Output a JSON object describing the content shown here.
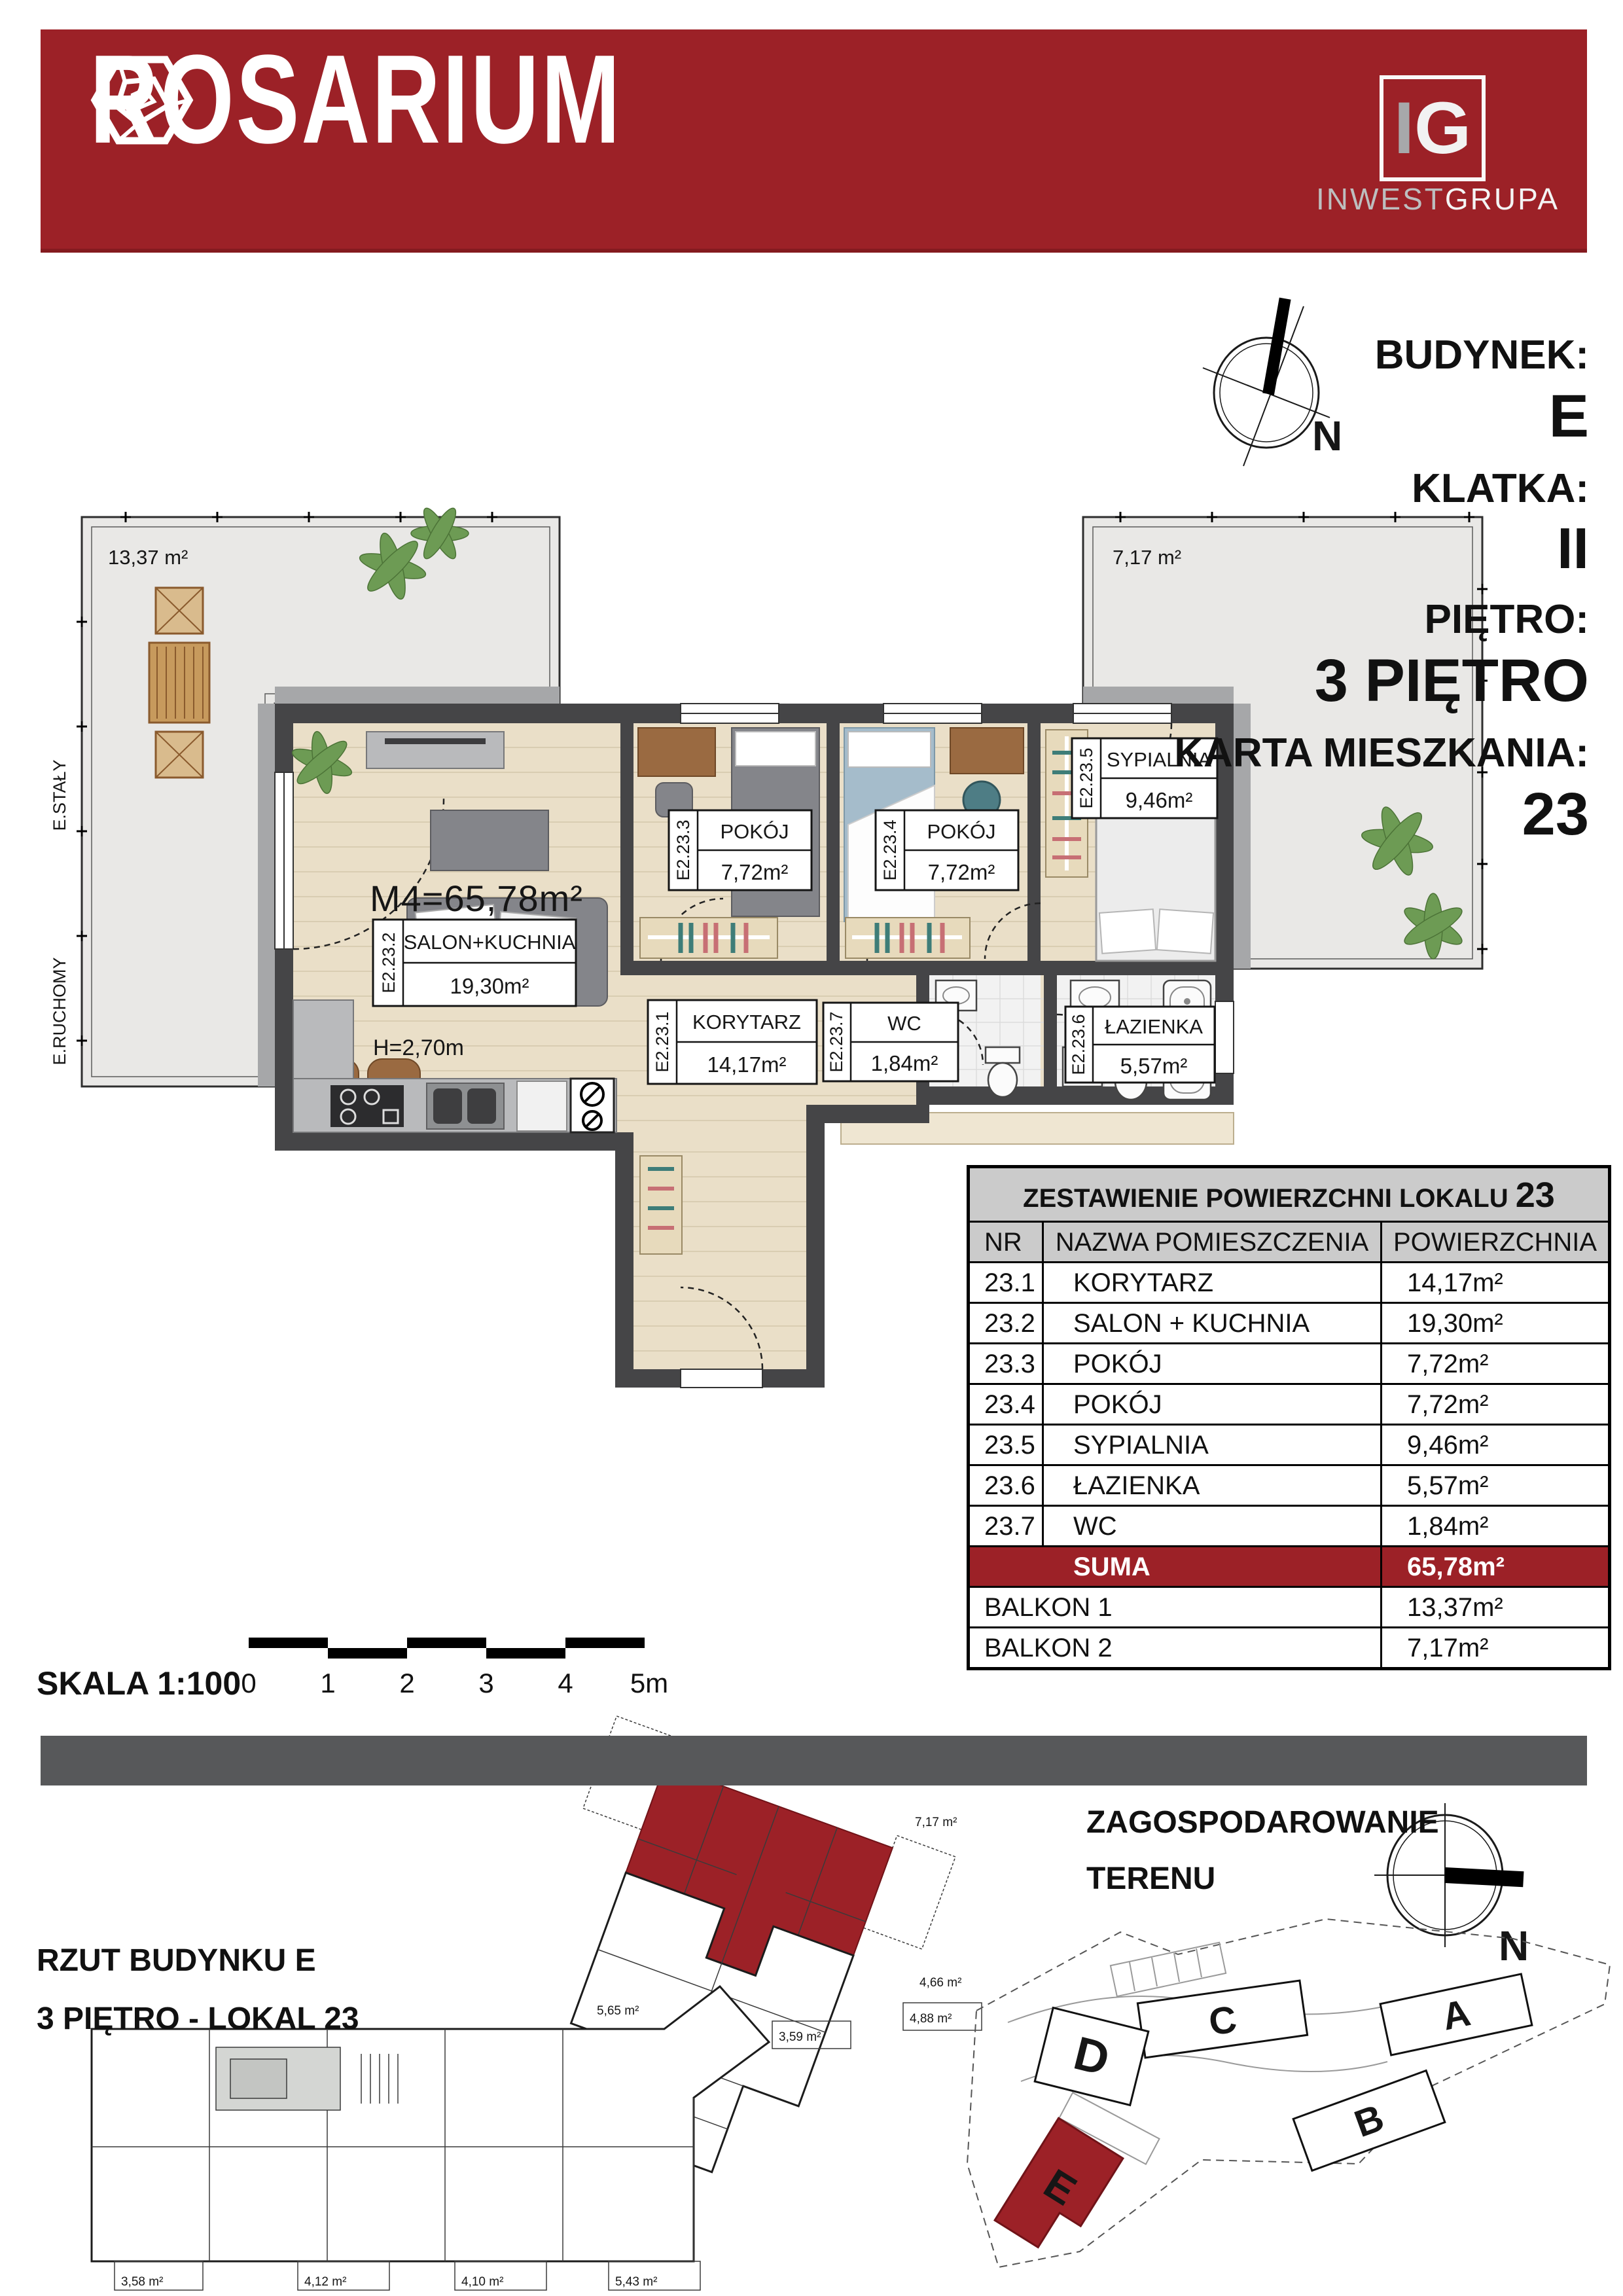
{
  "colors": {
    "brand_red": "#9c2127",
    "wall": "#454547",
    "wood": "#eadfc8",
    "terrace": "#e9e8e6",
    "table_header_bg": "#cbcbcb",
    "divider": "#57585a"
  },
  "header": {
    "brand": "ROSARIUM",
    "developer_monogram_i": "I",
    "developer_monogram_g": "G",
    "developer_part1": "INWEST",
    "developer_part2": "GRUPA"
  },
  "info_panel": {
    "budynek_label": "BUDYNEK:",
    "budynek_value": "E",
    "klatka_label": "KLATKA:",
    "klatka_value": "II",
    "pietro_label": "PIĘTRO:",
    "pietro_value": "3 PIĘTRO",
    "karta_label": "KARTA MIESZKANIA:",
    "karta_value": "23",
    "compass_n": "N"
  },
  "floor_plan": {
    "m4": "M4=65,78m²",
    "height_label": "H=2,70m",
    "balcony1_area": "13,37 m²",
    "balcony2_area": "7,17 m²",
    "edge_label_staly": "E.STAŁY",
    "edge_label_ruchomy": "E.RUCHOMY",
    "rooms": [
      {
        "id": "E2.23.1",
        "name": "KORYTARZ",
        "area": "14,17m²"
      },
      {
        "id": "E2.23.2",
        "name": "SALON+KUCHNIA",
        "area": "19,30m²"
      },
      {
        "id": "E2.23.3",
        "name": "POKÓJ",
        "area": "7,72m²"
      },
      {
        "id": "E2.23.4",
        "name": "POKÓJ",
        "area": "7,72m²"
      },
      {
        "id": "E2.23.5",
        "name": "SYPIALNIA",
        "area": "9,46m²"
      },
      {
        "id": "E2.23.6",
        "name": "ŁAZIENKA",
        "area": "5,57m²"
      },
      {
        "id": "E2.23.7",
        "name": "WC",
        "area": "1,84m²"
      }
    ]
  },
  "table": {
    "title": "ZESTAWIENIE POWIERZCHNI LOKALU",
    "title_number": "23",
    "headers": [
      "NR",
      "NAZWA POMIESZCZENIA",
      "POWIERZCHNIA"
    ],
    "rows": [
      {
        "nr": "23.1",
        "name": "KORYTARZ",
        "area": "14,17m²"
      },
      {
        "nr": "23.2",
        "name": "SALON + KUCHNIA",
        "area": "19,30m²"
      },
      {
        "nr": "23.3",
        "name": "POKÓJ",
        "area": "7,72m²"
      },
      {
        "nr": "23.4",
        "name": "POKÓJ",
        "area": "7,72m²"
      },
      {
        "nr": "23.5",
        "name": "SYPIALNIA",
        "area": "9,46m²"
      },
      {
        "nr": "23.6",
        "name": "ŁAZIENKA",
        "area": "5,57m²"
      },
      {
        "nr": "23.7",
        "name": "WC",
        "area": "1,84m²"
      }
    ],
    "suma_label": "SUMA",
    "suma_area": "65,78m²",
    "extra_rows": [
      {
        "name": "BALKON 1",
        "area": "13,37m²"
      },
      {
        "name": "BALKON 2",
        "area": "7,17m²"
      }
    ]
  },
  "scale_bar": {
    "label": "SKALA 1:100",
    "ticks": [
      "0",
      "1",
      "2",
      "3",
      "4",
      "5m"
    ]
  },
  "bottom": {
    "rzut_line1": "RZUT BUDYNKU E",
    "rzut_line2": "3 PIĘTRO - LOKAL 23",
    "site_title_line1": "ZAGOSPODAROWANIE",
    "site_title_line2": "TERENU",
    "compass_n": "N",
    "buildings": [
      "A",
      "B",
      "C",
      "D",
      "E"
    ],
    "building_plan_labels": [
      "3,58 m²",
      "4,12 m²",
      "4,10 m²",
      "5,43 m²",
      "5,43 m²",
      "3,59 m²",
      "4,88 m²"
    ],
    "wing_labels": [
      "13,37 m²",
      "7,17 m²",
      "5,65 m²",
      "4,66 m²"
    ]
  }
}
